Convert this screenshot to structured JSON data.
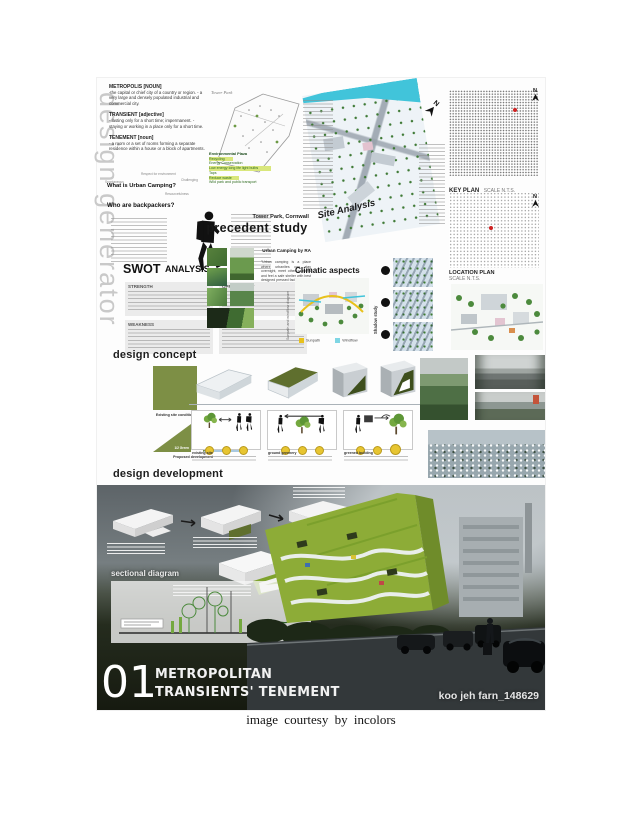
{
  "caption": "image courtesy by incolors",
  "colors": {
    "accent_green": "#7d8f45",
    "water_cyan": "#41c4da",
    "building_green": "#8dac37",
    "highlight_green": "#c6db4a",
    "sun_yellow": "#e8c11c"
  },
  "poster": {
    "side_label": "design generator",
    "north_label": "N",
    "definitions": [
      {
        "term": "METROPOLIS [NOUN]",
        "def": "-the capital or chief city of a country or region. - a very large and densely populated industrial and commercial city."
      },
      {
        "term": "TRANSIENT [adjective]",
        "def": "- lasting only for a short time; impermanent. - staying or working in a place only for a short time."
      },
      {
        "term": "TENEMENT [noun]",
        "def": "- a room or a set of rooms forming a separate residence within a house or a block of apartments."
      }
    ],
    "mindmap": {
      "title": "What is Urban Camping?",
      "satellites": [
        "Respect for environment",
        "Challenging",
        "Spontaneous",
        "Resourcefulness"
      ]
    },
    "backpackers_title": "Who are backpackers?",
    "swot": {
      "title": "SWOT",
      "subtitle": "ANALYSIS",
      "quadrants": [
        "STRENGTH",
        "OPPORTUNITY",
        "WEAKNESS",
        "THREAT"
      ]
    },
    "precedent": {
      "plan_label": "Tower Park",
      "features": [
        "Environmental Plaza",
        "Recycling",
        "Energy Conservation",
        "Low energy long life light bulbs",
        "Taps",
        "Reduce waste",
        "Wild park and public transport"
      ],
      "location": "Tower Park, Cornwall",
      "title": "precedent study",
      "case_title": "Urban Camping by RA",
      "case_quote": "\"Urban camping is a place where urbanites can stay overnight, meet other campers and feel a safe shelter with best designed pressed facilities.\""
    },
    "site_analysis_label": "Site Analysis",
    "climatic": {
      "title": "Climatic aspects",
      "side_label": "Sunpath and windflow diagram",
      "shadow_label": "Shadow study",
      "legend": [
        "Sunpath",
        "Windflow"
      ]
    },
    "key_plan": {
      "title": "KEY PLAN",
      "scale": "SCALE N.T.S."
    },
    "location_plan": {
      "title": "LOCATION PLAN",
      "scale": "SCALE N.T.S."
    },
    "concept": {
      "heading": "design concept",
      "existing_label": "Existing site condition",
      "tri1": "1/2 Green",
      "plus": "+",
      "tri2a": "1/2 Green",
      "tri2b": "1/2 Transient's tenement",
      "proposed_label": "Proposed development",
      "cards": [
        {
          "caption": "existing site"
        },
        {
          "caption": "ground greenery"
        },
        {
          "caption": "greened building"
        }
      ]
    },
    "development": {
      "heading": "design development",
      "section_label": "sectional diagram"
    },
    "titleblock": {
      "number": "01",
      "line1": "METROPOLITAN",
      "line2": "TRANSIENTS' TENEMENT"
    },
    "watermark": "koo jeh farn_148629"
  }
}
